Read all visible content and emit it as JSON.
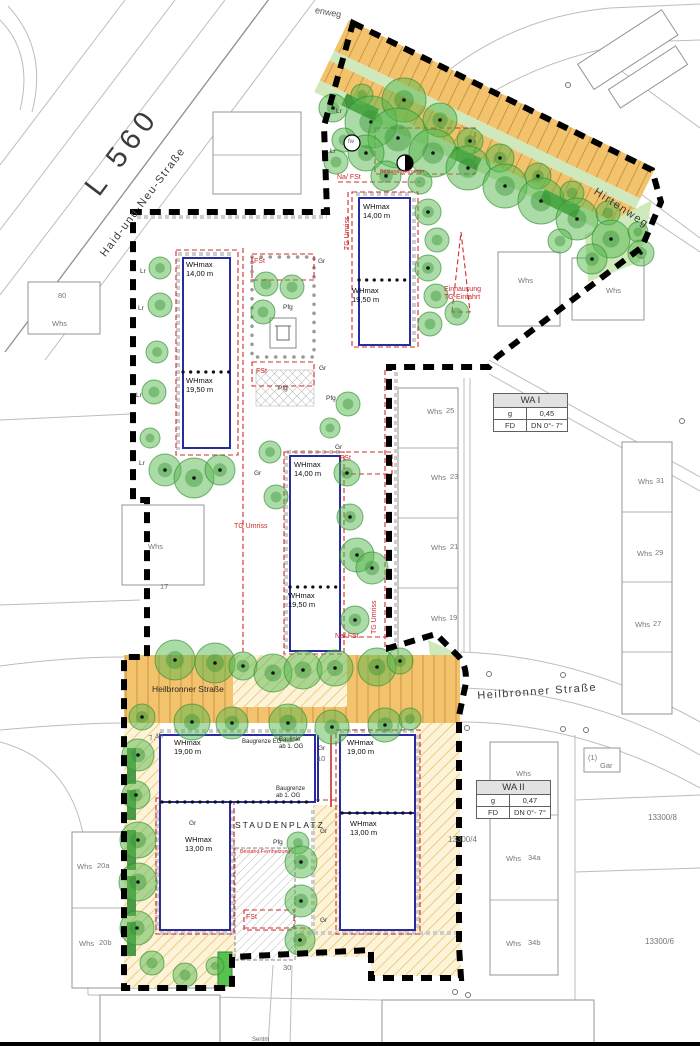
{
  "map": {
    "title_hint": "site development plan",
    "colors": {
      "boundary": "#000000",
      "building_envelope_blue": "#2b2ba0",
      "annotation_red": "#cf2b2b",
      "street_orange": "#f2c26d",
      "hatch_yellow": "#fcf3d9",
      "hatch_line": "#e6b84e",
      "tree_green": "#57b84d",
      "hedge_green": "#2e8b2e",
      "cadastre_gray": "#bdbdbd"
    },
    "zoning": {
      "wa1": {
        "title": "WA I",
        "rows": [
          [
            "g",
            "0,45"
          ],
          [
            "FD",
            "DN 0°- 7°"
          ]
        ]
      },
      "wa2": {
        "title": "WA II",
        "rows": [
          [
            "g",
            "0,47"
          ],
          [
            "FD",
            "DN 0°- 7°"
          ]
        ]
      }
    },
    "labels": [
      {
        "t": "L 560",
        "x": 78,
        "y": 182,
        "r": -53,
        "c": "big",
        "n": "street-label-l560"
      },
      {
        "t": "Haid-und-Neu-Straße",
        "x": 98,
        "y": 252,
        "r": -53,
        "c": "road",
        "n": "street-label-haid-und-neu"
      },
      {
        "t": "Hirtenweg",
        "x": 598,
        "y": 186,
        "r": 33,
        "c": "road",
        "n": "street-label-hirtenweg"
      },
      {
        "t": "enweg",
        "x": 316,
        "y": 5,
        "r": 10,
        "c": "roadsm",
        "n": "street-label-partial"
      },
      {
        "t": "Heilbronner Straße",
        "x": 152,
        "y": 684,
        "c": "strip",
        "n": "street-label-heilbronner-strip"
      },
      {
        "t": "Heilbronner Straße",
        "x": 477,
        "y": 690,
        "r": -4,
        "c": "road",
        "n": "street-label-heilbronner"
      },
      {
        "t": "WHmax\n14,00 m",
        "x": 186,
        "y": 261,
        "c": "wh"
      },
      {
        "t": "WHmax\n19,50 m",
        "x": 186,
        "y": 377,
        "c": "wh"
      },
      {
        "t": "WHmax\n14,00 m",
        "x": 363,
        "y": 203,
        "c": "wh"
      },
      {
        "t": "WHmax\n19,50 m",
        "x": 352,
        "y": 287,
        "c": "wh"
      },
      {
        "t": "WHmax\n14,00 m",
        "x": 294,
        "y": 461,
        "c": "wh"
      },
      {
        "t": "WHmax\n19,50 m",
        "x": 288,
        "y": 592,
        "c": "wh"
      },
      {
        "t": "WHmax\n19,00 m",
        "x": 174,
        "y": 739,
        "c": "wh"
      },
      {
        "t": "WHmax\n19,00 m",
        "x": 347,
        "y": 739,
        "c": "wh"
      },
      {
        "t": "WHmax\n13,00 m",
        "x": 185,
        "y": 836,
        "c": "wh"
      },
      {
        "t": "WHmax\n13,00 m",
        "x": 350,
        "y": 820,
        "c": "wh"
      },
      {
        "t": "Baugrenze EG",
        "x": 242,
        "y": 739,
        "c": "bau"
      },
      {
        "t": "Baulinie\nab 1. OG",
        "x": 279,
        "y": 737,
        "c": "bau"
      },
      {
        "t": "Baugrenze\nab 1. OG",
        "x": 276,
        "y": 786,
        "c": "bau"
      },
      {
        "t": "STAUDENPLATZ",
        "x": 235,
        "y": 820,
        "c": "platz",
        "n": "staudenplatz-label"
      },
      {
        "t": "Na/ FSt",
        "x": 337,
        "y": 174,
        "c": "red"
      },
      {
        "t": "Na/ FSt",
        "x": 335,
        "y": 633,
        "c": "red"
      },
      {
        "t": "FSt",
        "x": 254,
        "y": 258,
        "c": "red"
      },
      {
        "t": "FSt",
        "x": 256,
        "y": 368,
        "c": "red"
      },
      {
        "t": "FSt",
        "x": 340,
        "y": 455,
        "c": "red"
      },
      {
        "t": "FSt",
        "x": 246,
        "y": 914,
        "c": "red"
      },
      {
        "t": "TG Umriss",
        "x": 344,
        "y": 250,
        "r": -90,
        "c": "red"
      },
      {
        "t": "TG Umriss",
        "x": 371,
        "y": 634,
        "r": -90,
        "c": "red"
      },
      {
        "t": "TG Umriss",
        "x": 234,
        "y": 523,
        "c": "red"
      },
      {
        "t": "Einhausung\nTG-Einfahrt",
        "x": 444,
        "y": 286,
        "c": "red"
      },
      {
        "t": "Bestand Umformer",
        "x": 380,
        "y": 169,
        "c": "redtiny"
      },
      {
        "t": "Bestand Fernheizung",
        "x": 240,
        "y": 849,
        "c": "redtiny"
      },
      {
        "t": "fw",
        "x": 348,
        "y": 139,
        "c": "tiny"
      },
      {
        "t": "Pfg",
        "x": 283,
        "y": 304,
        "c": "gr"
      },
      {
        "t": "Pfg",
        "x": 278,
        "y": 385,
        "c": "gr"
      },
      {
        "t": "Pfg",
        "x": 326,
        "y": 395,
        "c": "gr"
      },
      {
        "t": "Pfg",
        "x": 273,
        "y": 839,
        "c": "gr"
      },
      {
        "t": "Gr",
        "x": 318,
        "y": 258,
        "c": "gr"
      },
      {
        "t": "Gr",
        "x": 319,
        "y": 365,
        "c": "gr"
      },
      {
        "t": "Gr",
        "x": 254,
        "y": 470,
        "c": "gr"
      },
      {
        "t": "Gr",
        "x": 335,
        "y": 444,
        "c": "gr"
      },
      {
        "t": "Gr",
        "x": 189,
        "y": 820,
        "c": "gr"
      },
      {
        "t": "Gr",
        "x": 320,
        "y": 828,
        "c": "gr"
      },
      {
        "t": "Gr",
        "x": 318,
        "y": 745,
        "c": "gr"
      },
      {
        "t": "Gr",
        "x": 320,
        "y": 917,
        "c": "gr"
      },
      {
        "t": "Lr",
        "x": 140,
        "y": 268,
        "c": "gr"
      },
      {
        "t": "Lr",
        "x": 138,
        "y": 305,
        "c": "gr"
      },
      {
        "t": "Lr",
        "x": 136,
        "y": 392,
        "c": "gr"
      },
      {
        "t": "Lr",
        "x": 139,
        "y": 460,
        "c": "gr"
      },
      {
        "t": "Lr",
        "x": 336,
        "y": 108,
        "c": "gr"
      },
      {
        "t": "Lr",
        "x": 330,
        "y": 148,
        "c": "gr"
      },
      {
        "t": "10",
        "x": 317,
        "y": 755,
        "c": "num"
      },
      {
        "t": "30",
        "x": 283,
        "y": 964,
        "c": "num"
      },
      {
        "t": "7,45",
        "x": 148,
        "y": 735,
        "r": -15,
        "c": "num"
      },
      {
        "t": "Sentm",
        "x": 252,
        "y": 1037,
        "c": "tiny"
      },
      {
        "t": "13300/4",
        "x": 448,
        "y": 835,
        "c": "parcel",
        "n": "parcel-13300-4"
      },
      {
        "t": "13300/8",
        "x": 648,
        "y": 813,
        "c": "parcel",
        "n": "parcel-13300-8"
      },
      {
        "t": "13300/6",
        "x": 645,
        "y": 937,
        "c": "parcel",
        "n": "parcel-13300-6"
      },
      {
        "t": "80",
        "x": 58,
        "y": 292,
        "c": "whs"
      },
      {
        "t": "Whs",
        "x": 52,
        "y": 320,
        "c": "whs"
      },
      {
        "t": "Whs",
        "x": 148,
        "y": 543,
        "c": "whs"
      },
      {
        "t": "17",
        "x": 160,
        "y": 583,
        "c": "whs"
      },
      {
        "t": "Whs",
        "x": 518,
        "y": 277,
        "c": "whs"
      },
      {
        "t": "Whs",
        "x": 606,
        "y": 287,
        "c": "whs"
      },
      {
        "t": "Whs",
        "x": 427,
        "y": 408,
        "c": "whs"
      },
      {
        "t": "25",
        "x": 446,
        "y": 407,
        "c": "whs"
      },
      {
        "t": "Whs",
        "x": 431,
        "y": 474,
        "c": "whs"
      },
      {
        "t": "23",
        "x": 450,
        "y": 473,
        "c": "whs"
      },
      {
        "t": "Whs",
        "x": 431,
        "y": 544,
        "c": "whs"
      },
      {
        "t": "21",
        "x": 450,
        "y": 543,
        "c": "whs"
      },
      {
        "t": "Whs",
        "x": 431,
        "y": 615,
        "c": "whs"
      },
      {
        "t": "19",
        "x": 449,
        "y": 614,
        "c": "whs"
      },
      {
        "t": "Whs",
        "x": 638,
        "y": 478,
        "c": "whs"
      },
      {
        "t": "31",
        "x": 656,
        "y": 477,
        "c": "whs"
      },
      {
        "t": "Whs",
        "x": 637,
        "y": 550,
        "c": "whs"
      },
      {
        "t": "29",
        "x": 655,
        "y": 549,
        "c": "whs"
      },
      {
        "t": "Whs",
        "x": 635,
        "y": 621,
        "c": "whs"
      },
      {
        "t": "27",
        "x": 653,
        "y": 620,
        "c": "whs"
      },
      {
        "t": "Whs",
        "x": 516,
        "y": 770,
        "c": "whs"
      },
      {
        "t": "(1)",
        "x": 588,
        "y": 754,
        "c": "whs"
      },
      {
        "t": "Gar",
        "x": 600,
        "y": 762,
        "c": "whs"
      },
      {
        "t": "Whs",
        "x": 506,
        "y": 855,
        "c": "whs"
      },
      {
        "t": "34a",
        "x": 528,
        "y": 854,
        "c": "whs"
      },
      {
        "t": "Whs",
        "x": 506,
        "y": 940,
        "c": "whs"
      },
      {
        "t": "34b",
        "x": 528,
        "y": 939,
        "c": "whs"
      },
      {
        "t": "Whs",
        "x": 77,
        "y": 863,
        "c": "whs"
      },
      {
        "t": "20a",
        "x": 97,
        "y": 862,
        "c": "whs"
      },
      {
        "t": "Whs",
        "x": 79,
        "y": 940,
        "c": "whs"
      },
      {
        "t": "20b",
        "x": 99,
        "y": 939,
        "c": "whs"
      }
    ],
    "trees": [
      [
        333,
        108,
        14
      ],
      [
        362,
        95,
        11
      ],
      [
        371,
        122,
        26
      ],
      [
        404,
        100,
        22
      ],
      [
        344,
        140,
        12
      ],
      [
        398,
        138,
        30
      ],
      [
        440,
        120,
        17
      ],
      [
        433,
        153,
        24
      ],
      [
        470,
        141,
        13
      ],
      [
        468,
        168,
        22
      ],
      [
        500,
        158,
        14
      ],
      [
        505,
        186,
        22
      ],
      [
        538,
        176,
        13
      ],
      [
        541,
        201,
        23
      ],
      [
        572,
        193,
        12
      ],
      [
        577,
        219,
        21
      ],
      [
        608,
        213,
        12
      ],
      [
        611,
        239,
        19
      ],
      [
        638,
        232,
        10
      ],
      [
        641,
        253,
        13
      ],
      [
        592,
        259,
        15
      ],
      [
        560,
        241,
        12
      ],
      [
        366,
        153,
        18
      ],
      [
        336,
        162,
        12
      ],
      [
        386,
        176,
        15
      ],
      [
        420,
        182,
        12
      ],
      [
        428,
        212,
        13
      ],
      [
        437,
        240,
        12
      ],
      [
        428,
        268,
        13
      ],
      [
        436,
        296,
        12
      ],
      [
        430,
        324,
        12
      ],
      [
        457,
        313,
        12
      ],
      [
        266,
        284,
        12
      ],
      [
        292,
        287,
        12
      ],
      [
        263,
        312,
        12
      ],
      [
        160,
        268,
        11
      ],
      [
        160,
        305,
        12
      ],
      [
        157,
        352,
        11
      ],
      [
        154,
        392,
        12
      ],
      [
        150,
        438,
        10
      ],
      [
        165,
        470,
        16
      ],
      [
        194,
        478,
        20
      ],
      [
        220,
        470,
        15
      ],
      [
        347,
        473,
        13
      ],
      [
        350,
        517,
        13
      ],
      [
        357,
        555,
        17
      ],
      [
        372,
        568,
        16
      ],
      [
        355,
        620,
        14
      ],
      [
        270,
        452,
        11
      ],
      [
        276,
        497,
        12
      ],
      [
        348,
        404,
        12
      ],
      [
        330,
        428,
        10
      ],
      [
        175,
        660,
        20
      ],
      [
        215,
        663,
        20
      ],
      [
        243,
        666,
        14
      ],
      [
        273,
        673,
        19
      ],
      [
        303,
        670,
        19
      ],
      [
        335,
        668,
        18
      ],
      [
        377,
        667,
        19
      ],
      [
        400,
        661,
        13
      ],
      [
        142,
        717,
        13
      ],
      [
        192,
        722,
        18
      ],
      [
        232,
        723,
        16
      ],
      [
        288,
        723,
        19
      ],
      [
        332,
        727,
        17
      ],
      [
        385,
        725,
        17
      ],
      [
        410,
        719,
        11
      ],
      [
        138,
        755,
        16
      ],
      [
        136,
        795,
        14
      ],
      [
        138,
        840,
        18
      ],
      [
        138,
        882,
        19
      ],
      [
        137,
        928,
        17
      ],
      [
        152,
        963,
        12
      ],
      [
        185,
        975,
        12
      ],
      [
        215,
        966,
        9
      ],
      [
        298,
        843,
        11
      ],
      [
        301,
        862,
        16
      ],
      [
        301,
        901,
        16
      ],
      [
        300,
        940,
        15
      ]
    ]
  }
}
